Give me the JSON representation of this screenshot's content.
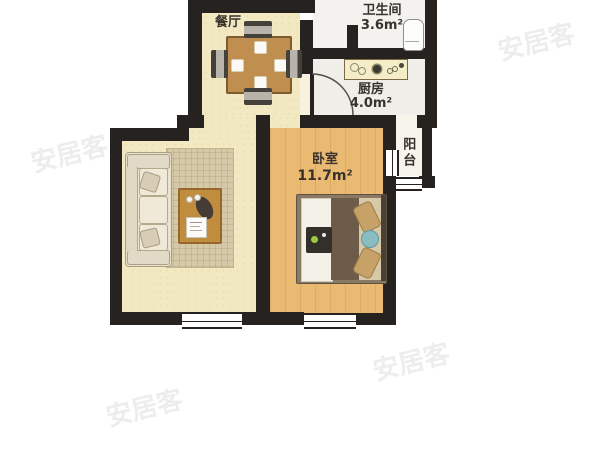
{
  "watermark": "安居客",
  "rooms": {
    "dining": {
      "name": "餐厅"
    },
    "bathroom": {
      "name": "卫生间",
      "area": "3.6m²"
    },
    "kitchen": {
      "name": "厨房",
      "area": "4.0m²"
    },
    "bedroom": {
      "name": "卧室",
      "area": "11.7m²"
    },
    "balcony": {
      "name": "阳台"
    }
  },
  "colors": {
    "wall": "#26221f",
    "floor_living_dining": "#f2e8c2",
    "floor_bedroom": "#eaba72",
    "floor_kitchen": "#efeee9",
    "floor_bathroom": "#f3f2ee",
    "floor_balcony": "#f7f4ec",
    "watermark_gray": "#acacac"
  }
}
